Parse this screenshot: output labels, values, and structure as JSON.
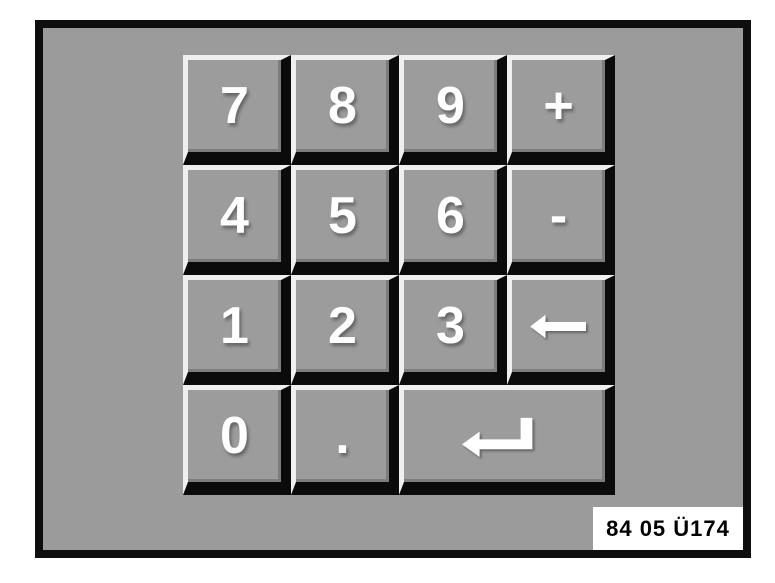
{
  "window": {
    "page_background": "#ffffff"
  },
  "frame": {
    "background": "#9b9b9b",
    "border_color": "#0e0e0e"
  },
  "keypad": {
    "keys": [
      {
        "id": "7",
        "label": "7"
      },
      {
        "id": "8",
        "label": "8"
      },
      {
        "id": "9",
        "label": "9"
      },
      {
        "id": "plus",
        "label": "+"
      },
      {
        "id": "4",
        "label": "4"
      },
      {
        "id": "5",
        "label": "5"
      },
      {
        "id": "6",
        "label": "6"
      },
      {
        "id": "minus",
        "label": "-"
      },
      {
        "id": "1",
        "label": "1"
      },
      {
        "id": "2",
        "label": "2"
      },
      {
        "id": "3",
        "label": "3"
      },
      {
        "id": "backspace",
        "icon": "backspace-arrow-icon"
      },
      {
        "id": "0",
        "label": "0"
      },
      {
        "id": "decimal",
        "label": "."
      },
      {
        "id": "enter",
        "icon": "enter-return-icon",
        "span": 2
      }
    ],
    "key_colors": {
      "face": "#9c9c9c",
      "bevel_light": "#efefef",
      "bevel_shadow": "#0b0b0b",
      "inner_edge": "#7d7d7d",
      "glyph": "#ffffff"
    }
  },
  "caption": {
    "text": "84 05 Ü174",
    "background": "#ffffff",
    "color": "#000000"
  }
}
